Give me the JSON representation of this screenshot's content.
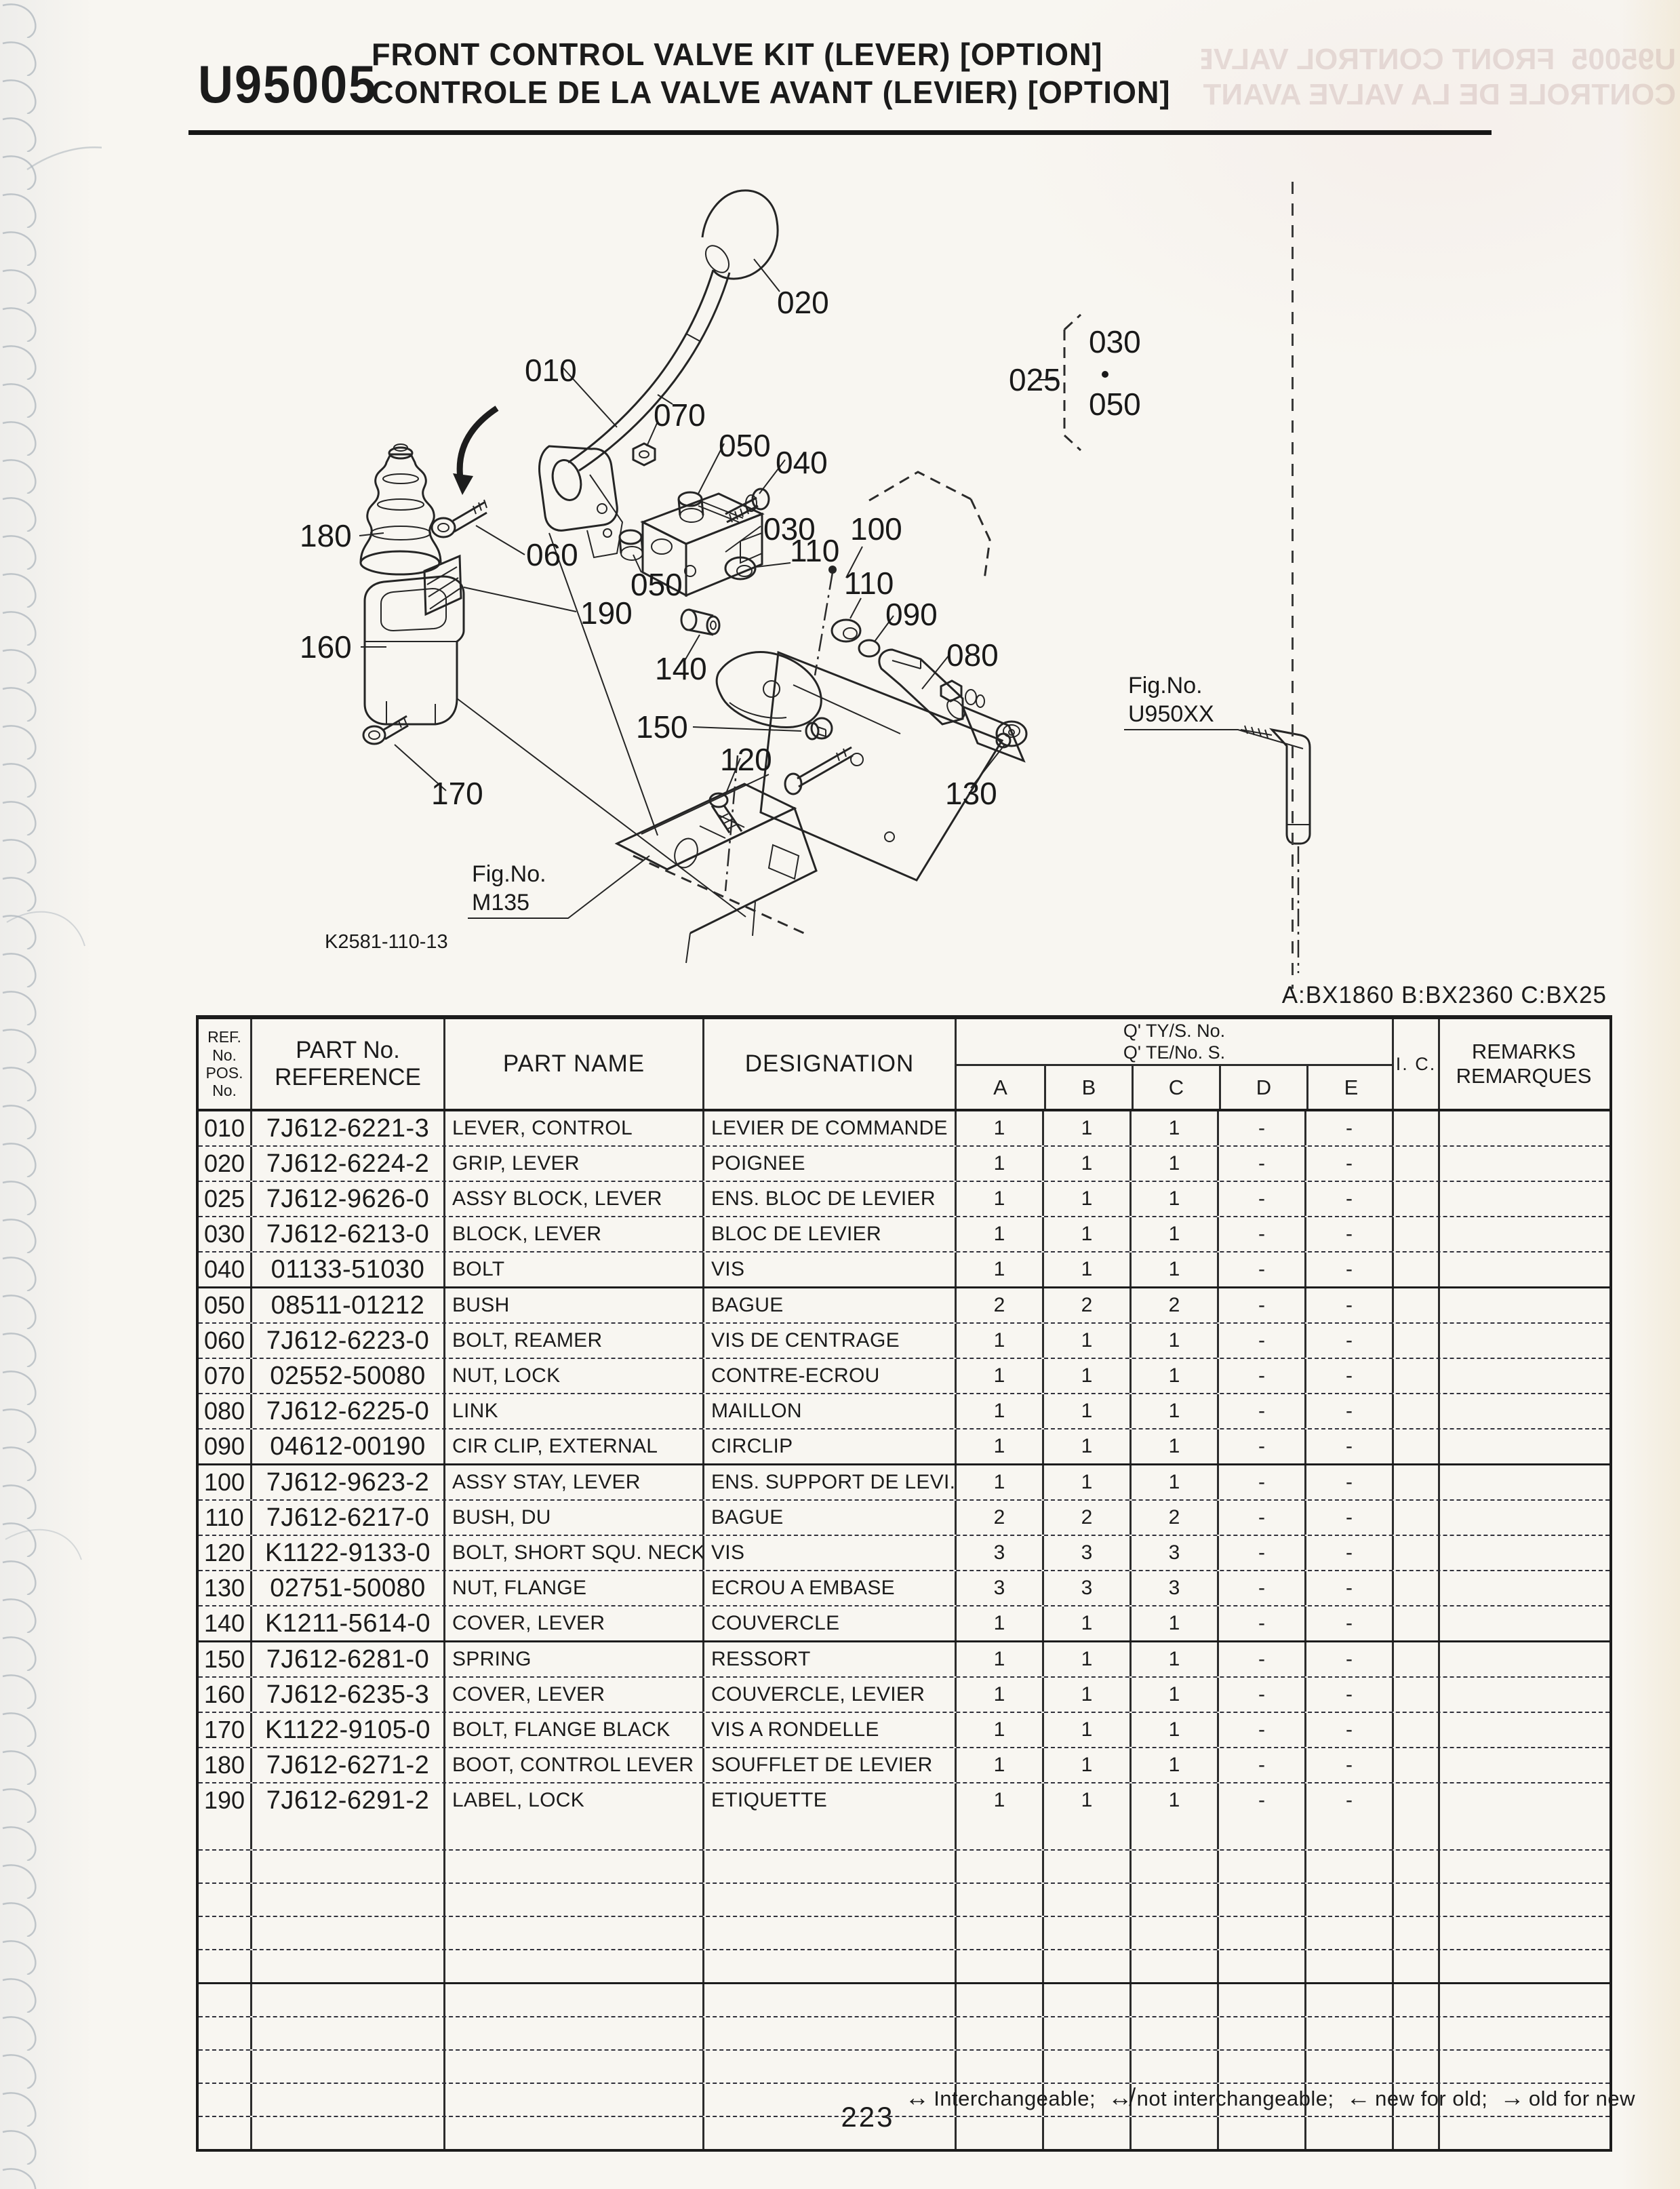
{
  "page": {
    "code": "U95005",
    "title_en": "FRONT CONTROL VALVE KIT (LEVER) [OPTION]",
    "title_fr": "CONTROLE DE LA VALVE AVANT (LEVIER) [OPTION]",
    "models_note": "A:BX1860 B:BX2360 C:BX25",
    "page_number": "223",
    "legend": [
      {
        "symbol": "↔",
        "text": "Interchangeable;"
      },
      {
        "symbol": "↮",
        "text": "not interchangeable;"
      },
      {
        "symbol": "←",
        "text": "new for old;"
      },
      {
        "symbol": "→",
        "text": "old for new"
      }
    ]
  },
  "diagram": {
    "drawing_code": "K2581-110-13",
    "fig_ref_label": "Fig.No.",
    "fig_ref_1": "U950XX",
    "fig_ref_2": "M135",
    "labels": {
      "c010": "010",
      "c020": "020",
      "c025": "025",
      "c030a": "030",
      "c030b": "030",
      "c040": "040",
      "c050a": "050",
      "c050b": "050",
      "c050c": "050",
      "c060": "060",
      "c070": "070",
      "c080": "080",
      "c090": "090",
      "c100": "100",
      "c110a": "110",
      "c110b": "110",
      "c120": "120",
      "c130": "130",
      "c140": "140",
      "c150": "150",
      "c160": "160",
      "c170": "170",
      "c180": "180",
      "c190": "190"
    }
  },
  "table": {
    "headers": {
      "ref_line1": "REF. No.",
      "ref_line2": "POS. No.",
      "part_line1": "PART No.",
      "part_line2": "REFERENCE",
      "part_name": "PART NAME",
      "designation": "DESIGNATION",
      "qty_line1": "Q' TY/S. No.",
      "qty_line2": "Q' TE/No. S.",
      "qty_cols": [
        "A",
        "B",
        "C",
        "D",
        "E"
      ],
      "ic": "I. C.",
      "remarks_line1": "REMARKS",
      "remarks_line2": "REMARQUES"
    },
    "empty_row_count": 10,
    "rows": [
      {
        "ref": "010",
        "part_no": "7J612-6221-3",
        "name": "LEVER, CONTROL",
        "designation": "LEVIER DE COMMANDE",
        "qty": {
          "A": "1",
          "B": "1",
          "C": "1",
          "D": "-",
          "E": "-"
        }
      },
      {
        "ref": "020",
        "part_no": "7J612-6224-2",
        "name": "GRIP, LEVER",
        "designation": "POIGNEE",
        "qty": {
          "A": "1",
          "B": "1",
          "C": "1",
          "D": "-",
          "E": "-"
        }
      },
      {
        "ref": "025",
        "part_no": "7J612-9626-0",
        "name": "ASSY BLOCK, LEVER",
        "designation": "ENS. BLOC DE LEVIER",
        "qty": {
          "A": "1",
          "B": "1",
          "C": "1",
          "D": "-",
          "E": "-"
        }
      },
      {
        "ref": "030",
        "part_no": "7J612-6213-0",
        "name": "BLOCK, LEVER",
        "designation": "BLOC DE LEVIER",
        "qty": {
          "A": "1",
          "B": "1",
          "C": "1",
          "D": "-",
          "E": "-"
        }
      },
      {
        "ref": "040",
        "part_no": "01133-51030",
        "name": "BOLT",
        "designation": "VIS",
        "qty": {
          "A": "1",
          "B": "1",
          "C": "1",
          "D": "-",
          "E": "-"
        }
      },
      {
        "ref": "050",
        "part_no": "08511-01212",
        "name": "BUSH",
        "designation": "BAGUE",
        "qty": {
          "A": "2",
          "B": "2",
          "C": "2",
          "D": "-",
          "E": "-"
        }
      },
      {
        "ref": "060",
        "part_no": "7J612-6223-0",
        "name": "BOLT, REAMER",
        "designation": "VIS DE CENTRAGE",
        "qty": {
          "A": "1",
          "B": "1",
          "C": "1",
          "D": "-",
          "E": "-"
        }
      },
      {
        "ref": "070",
        "part_no": "02552-50080",
        "name": "NUT, LOCK",
        "designation": "CONTRE-ECROU",
        "qty": {
          "A": "1",
          "B": "1",
          "C": "1",
          "D": "-",
          "E": "-"
        }
      },
      {
        "ref": "080",
        "part_no": "7J612-6225-0",
        "name": "LINK",
        "designation": "MAILLON",
        "qty": {
          "A": "1",
          "B": "1",
          "C": "1",
          "D": "-",
          "E": "-"
        }
      },
      {
        "ref": "090",
        "part_no": "04612-00190",
        "name": "CIR CLIP, EXTERNAL",
        "designation": "CIRCLIP",
        "qty": {
          "A": "1",
          "B": "1",
          "C": "1",
          "D": "-",
          "E": "-"
        }
      },
      {
        "ref": "100",
        "part_no": "7J612-9623-2",
        "name": "ASSY STAY, LEVER",
        "designation": "ENS. SUPPORT DE LEVI.",
        "qty": {
          "A": "1",
          "B": "1",
          "C": "1",
          "D": "-",
          "E": "-"
        }
      },
      {
        "ref": "110",
        "part_no": "7J612-6217-0",
        "name": "BUSH, DU",
        "designation": "BAGUE",
        "qty": {
          "A": "2",
          "B": "2",
          "C": "2",
          "D": "-",
          "E": "-"
        }
      },
      {
        "ref": "120",
        "part_no": "K1122-9133-0",
        "name": "BOLT, SHORT SQU. NECK",
        "designation": "VIS",
        "qty": {
          "A": "3",
          "B": "3",
          "C": "3",
          "D": "-",
          "E": "-"
        }
      },
      {
        "ref": "130",
        "part_no": "02751-50080",
        "name": "NUT, FLANGE",
        "designation": "ECROU A EMBASE",
        "qty": {
          "A": "3",
          "B": "3",
          "C": "3",
          "D": "-",
          "E": "-"
        }
      },
      {
        "ref": "140",
        "part_no": "K1211-5614-0",
        "name": "COVER, LEVER",
        "designation": "COUVERCLE",
        "qty": {
          "A": "1",
          "B": "1",
          "C": "1",
          "D": "-",
          "E": "-"
        }
      },
      {
        "ref": "150",
        "part_no": "7J612-6281-0",
        "name": "SPRING",
        "designation": "RESSORT",
        "qty": {
          "A": "1",
          "B": "1",
          "C": "1",
          "D": "-",
          "E": "-"
        }
      },
      {
        "ref": "160",
        "part_no": "7J612-6235-3",
        "name": "COVER, LEVER",
        "designation": "COUVERCLE, LEVIER",
        "qty": {
          "A": "1",
          "B": "1",
          "C": "1",
          "D": "-",
          "E": "-"
        }
      },
      {
        "ref": "170",
        "part_no": "K1122-9105-0",
        "name": "BOLT, FLANGE BLACK",
        "designation": "VIS A RONDELLE",
        "qty": {
          "A": "1",
          "B": "1",
          "C": "1",
          "D": "-",
          "E": "-"
        }
      },
      {
        "ref": "180",
        "part_no": "7J612-6271-2",
        "name": "BOOT, CONTROL LEVER",
        "designation": "SOUFFLET DE LEVIER",
        "qty": {
          "A": "1",
          "B": "1",
          "C": "1",
          "D": "-",
          "E": "-"
        }
      },
      {
        "ref": "190",
        "part_no": "7J612-6291-2",
        "name": "LABEL, LOCK",
        "designation": "ETIQUETTE",
        "qty": {
          "A": "1",
          "B": "1",
          "C": "1",
          "D": "-",
          "E": "-"
        }
      }
    ]
  }
}
